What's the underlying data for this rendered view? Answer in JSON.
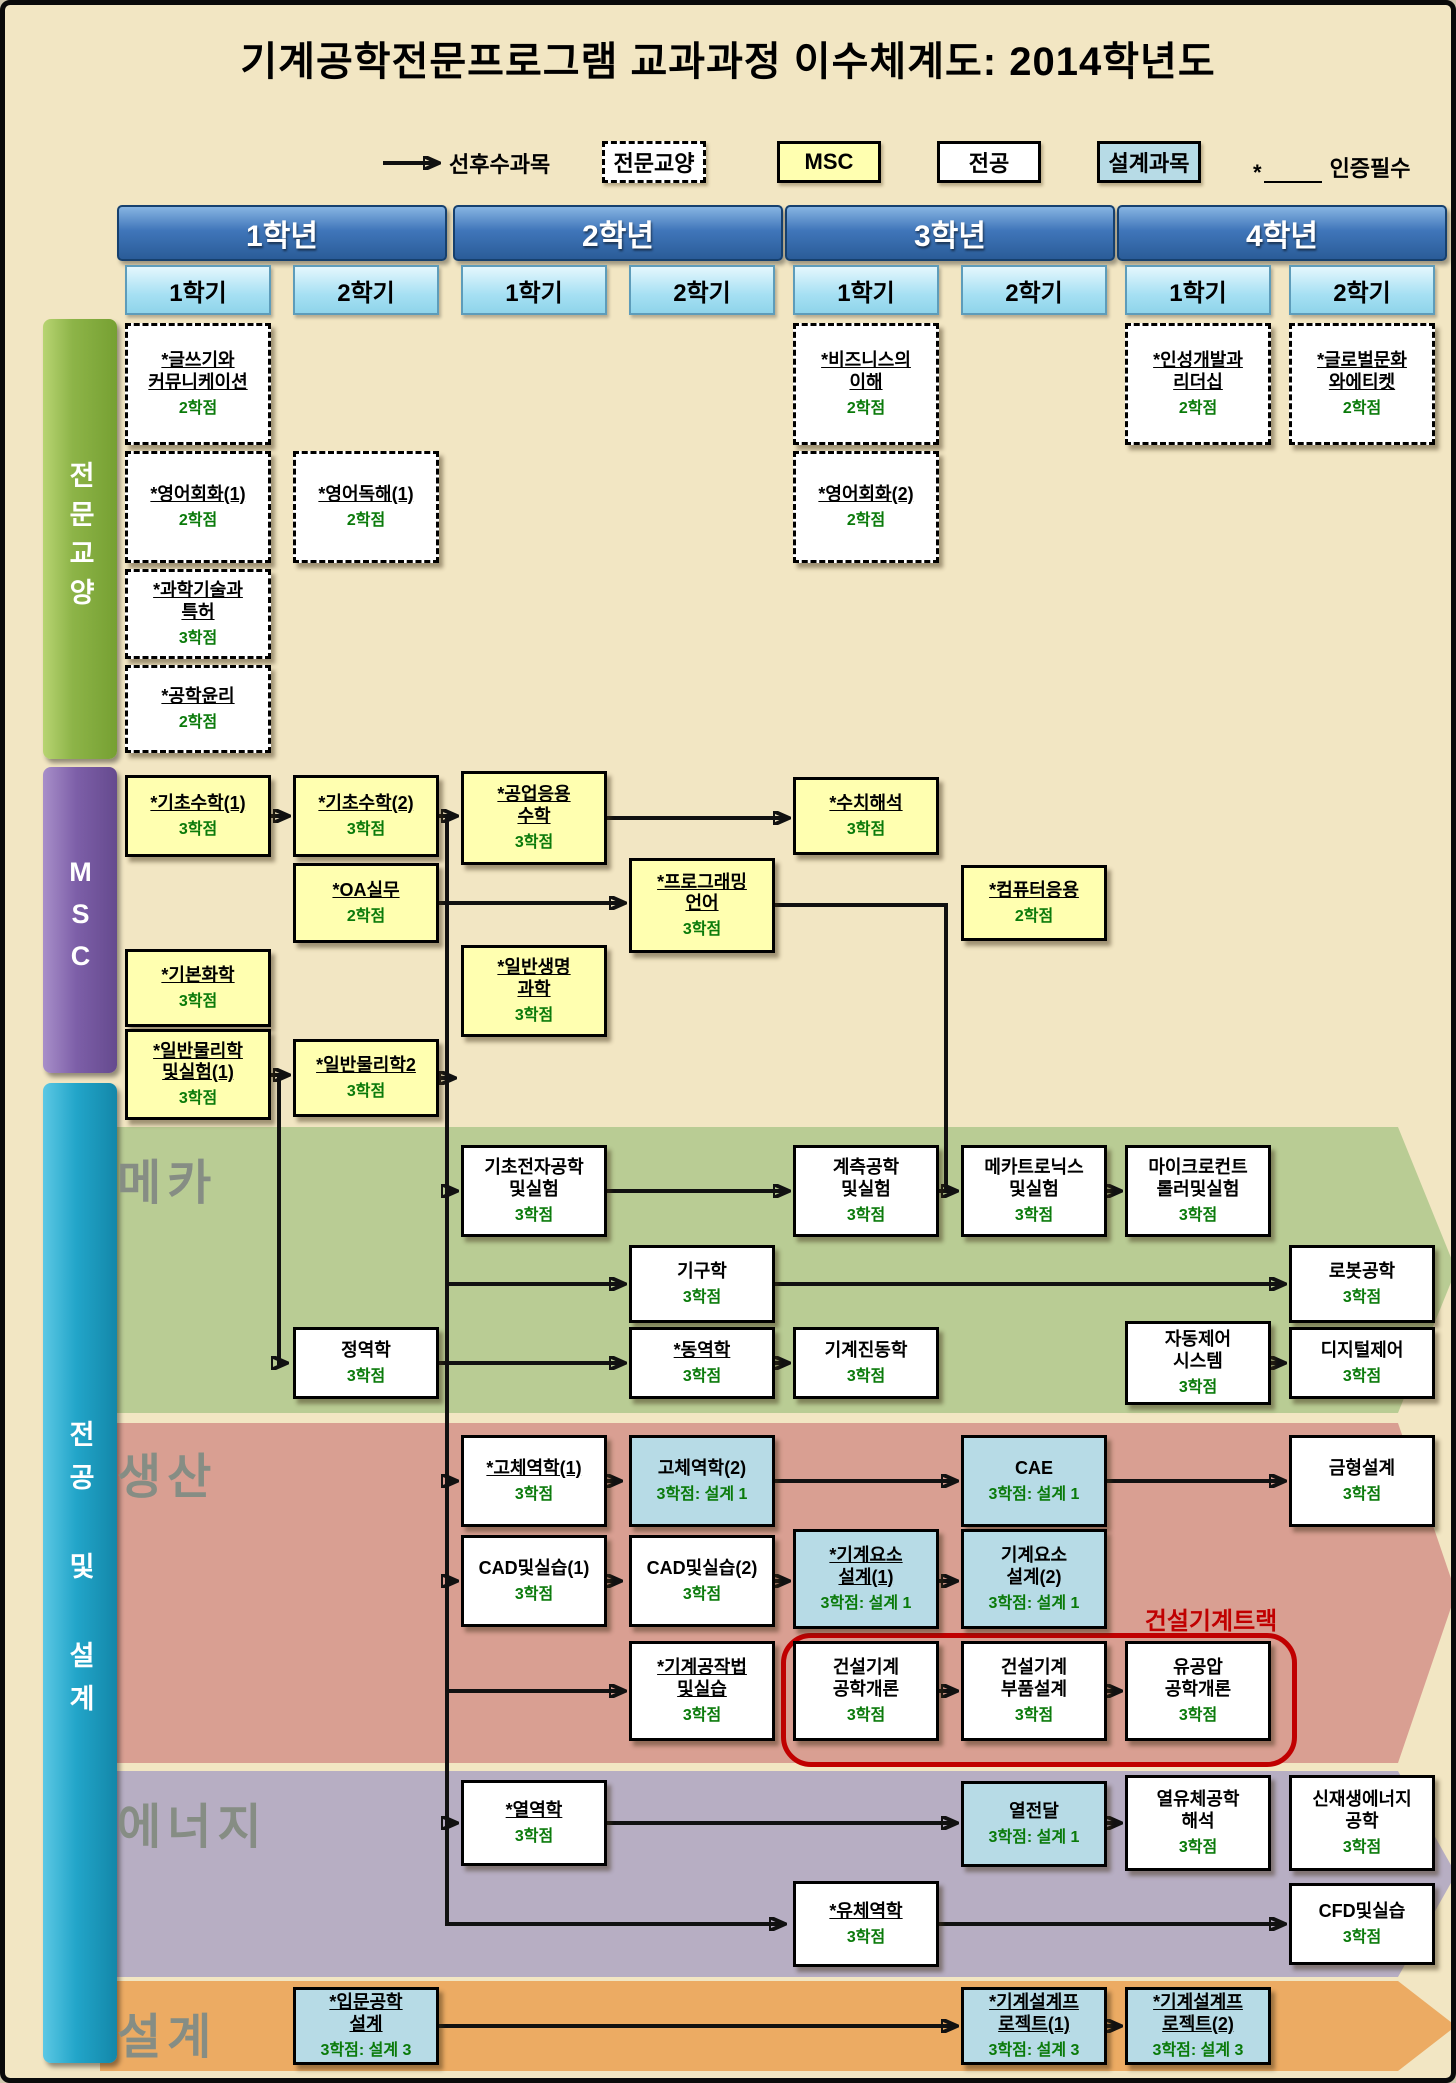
{
  "title": "기계공학전문프로그램 교과과정 이수체계도: 2014학년도",
  "legend": {
    "arrow_label": "선후수과목",
    "ge_label": "전문교양",
    "msc_label": "MSC",
    "major_label": "전공",
    "design_label": "설계과목",
    "cert_star": "*",
    "cert_label": "인증필수"
  },
  "header": {
    "years": [
      "1학년",
      "2학년",
      "3학년",
      "4학년"
    ],
    "semesters": [
      "1학기",
      "2학기",
      "1학기",
      "2학기",
      "1학기",
      "2학기",
      "1학기",
      "2학기"
    ]
  },
  "sidebars": [
    {
      "label": "전문교양"
    },
    {
      "label": "MSC"
    },
    {
      "label": "전공 및 설계"
    }
  ],
  "bands": [
    {
      "label": "메카"
    },
    {
      "label": "생산"
    },
    {
      "label": "에너지"
    },
    {
      "label": "설계"
    }
  ],
  "track": {
    "label": "건설기계트랙"
  },
  "colors": {
    "page_bg": "#f2e6c3",
    "year_bar_blue": "#2a5c98",
    "semester_tab_blue": "#a6e0f3",
    "ge_sidebar_green": "#8db448",
    "msc_sidebar_purple": "#7d5fa8",
    "major_sidebar_cyan": "#22a5c9",
    "band_mecha": "#b9cc94",
    "band_production": "#d99f92",
    "band_energy": "#b7aec3",
    "band_design": "#ecab63",
    "msc_box_yellow": "#ffffb0",
    "design_box_blue": "#b7dbe6",
    "credit_green": "#0a7a0a",
    "track_red": "#c00000"
  },
  "courses": [
    {
      "title": "*글쓰기와\n커뮤니케이션",
      "credit": "2학점",
      "category": "전문교양",
      "grade": 1,
      "semester": 1
    },
    {
      "title": "*영어회화(1)",
      "credit": "2학점",
      "category": "전문교양",
      "grade": 1,
      "semester": 1
    },
    {
      "title": "*과학기술과\n특허",
      "credit": "3학점",
      "category": "전문교양",
      "grade": 1,
      "semester": 1
    },
    {
      "title": "*공학윤리",
      "credit": "2학점",
      "category": "전문교양",
      "grade": 1,
      "semester": 1
    },
    {
      "title": "*영어독해(1)",
      "credit": "2학점",
      "category": "전문교양",
      "grade": 1,
      "semester": 2
    },
    {
      "title": "*비즈니스의\n이해",
      "credit": "2학점",
      "category": "전문교양",
      "grade": 3,
      "semester": 1
    },
    {
      "title": "*영어회화(2)",
      "credit": "2학점",
      "category": "전문교양",
      "grade": 3,
      "semester": 1
    },
    {
      "title": "*인성개발과\n리더십",
      "credit": "2학점",
      "category": "전문교양",
      "grade": 4,
      "semester": 1
    },
    {
      "title": "*글로벌문화\n와에티켓",
      "credit": "2학점",
      "category": "전문교양",
      "grade": 4,
      "semester": 2
    },
    {
      "title": "*기초수학(1)",
      "credit": "3학점",
      "category": "MSC",
      "grade": 1,
      "semester": 1
    },
    {
      "title": "*기초수학(2)",
      "credit": "3학점",
      "category": "MSC",
      "grade": 1,
      "semester": 2
    },
    {
      "title": "*공업응용\n수학",
      "credit": "3학점",
      "category": "MSC",
      "grade": 2,
      "semester": 1
    },
    {
      "title": "*수치해석",
      "credit": "3학점",
      "category": "MSC",
      "grade": 3,
      "semester": 1
    },
    {
      "title": "*OA실무",
      "credit": "2학점",
      "category": "MSC",
      "grade": 1,
      "semester": 2
    },
    {
      "title": "*프로그래밍\n언어",
      "credit": "3학점",
      "category": "MSC",
      "grade": 2,
      "semester": 2
    },
    {
      "title": "*컴퓨터응용",
      "credit": "2학점",
      "category": "MSC",
      "grade": 3,
      "semester": 2
    },
    {
      "title": "*기본화학",
      "credit": "3학점",
      "category": "MSC",
      "grade": 1,
      "semester": 1
    },
    {
      "title": "*일반생명\n과학",
      "credit": "3학점",
      "category": "MSC",
      "grade": 2,
      "semester": 1
    },
    {
      "title": "*일반물리학\n및실험(1)",
      "credit": "3학점",
      "category": "MSC",
      "grade": 1,
      "semester": 1
    },
    {
      "title": "*일반물리학2",
      "credit": "3학점",
      "category": "MSC",
      "grade": 1,
      "semester": 2
    },
    {
      "title": "기초전자공학\n및실험",
      "credit": "3학점",
      "category": "전공",
      "band": "메카",
      "grade": 2,
      "semester": 1
    },
    {
      "title": "계측공학\n및실험",
      "credit": "3학점",
      "category": "전공",
      "band": "메카",
      "grade": 3,
      "semester": 1
    },
    {
      "title": "메카트로닉스\n및실험",
      "credit": "3학점",
      "category": "전공",
      "band": "메카",
      "grade": 3,
      "semester": 2
    },
    {
      "title": "마이크로컨트\n롤러및실험",
      "credit": "3학점",
      "category": "전공",
      "band": "메카",
      "grade": 4,
      "semester": 1
    },
    {
      "title": "기구학",
      "credit": "3학점",
      "category": "전공",
      "band": "메카",
      "grade": 2,
      "semester": 2
    },
    {
      "title": "로봇공학",
      "credit": "3학점",
      "category": "전공",
      "band": "메카",
      "grade": 4,
      "semester": 2
    },
    {
      "title": "정역학",
      "credit": "3학점",
      "category": "전공",
      "band": "메카",
      "grade": 1,
      "semester": 2
    },
    {
      "title": "*동역학",
      "credit": "3학점",
      "category": "전공",
      "band": "메카",
      "grade": 2,
      "semester": 2
    },
    {
      "title": "기계진동학",
      "credit": "3학점",
      "category": "전공",
      "band": "메카",
      "grade": 3,
      "semester": 1
    },
    {
      "title": "자동제어\n시스템",
      "credit": "3학점",
      "category": "전공",
      "band": "메카",
      "grade": 4,
      "semester": 1
    },
    {
      "title": "디지털제어",
      "credit": "3학점",
      "category": "전공",
      "band": "메카",
      "grade": 4,
      "semester": 2
    },
    {
      "title": "*고체역학(1)",
      "credit": "3학점",
      "category": "전공",
      "band": "생산",
      "grade": 2,
      "semester": 1
    },
    {
      "title": "고체역학(2)",
      "credit": "3학점: 설계 1",
      "category": "설계과목",
      "band": "생산",
      "grade": 2,
      "semester": 2
    },
    {
      "title": "CAE",
      "credit": "3학점: 설계 1",
      "category": "설계과목",
      "band": "생산",
      "grade": 3,
      "semester": 2
    },
    {
      "title": "금형설계",
      "credit": "3학점",
      "category": "전공",
      "band": "생산",
      "grade": 4,
      "semester": 2
    },
    {
      "title": "CAD및실습(1)",
      "credit": "3학점",
      "category": "전공",
      "band": "생산",
      "grade": 2,
      "semester": 1
    },
    {
      "title": "CAD및실습(2)",
      "credit": "3학점",
      "category": "전공",
      "band": "생산",
      "grade": 2,
      "semester": 2
    },
    {
      "title": "*기계요소\n설계(1)",
      "credit": "3학점: 설계 1",
      "category": "설계과목",
      "band": "생산",
      "grade": 3,
      "semester": 1
    },
    {
      "title": "기계요소\n설계(2)",
      "credit": "3학점: 설계 1",
      "category": "설계과목",
      "band": "생산",
      "grade": 3,
      "semester": 2
    },
    {
      "title": "*기계공작법\n및실습",
      "credit": "3학점",
      "category": "전공",
      "band": "생산",
      "grade": 2,
      "semester": 2
    },
    {
      "title": "건설기계\n공학개론",
      "credit": "3학점",
      "category": "전공",
      "band": "생산",
      "grade": 3,
      "semester": 1
    },
    {
      "title": "건설기계\n부품설계",
      "credit": "3학점",
      "category": "전공",
      "band": "생산",
      "grade": 3,
      "semester": 2
    },
    {
      "title": "유공압\n공학개론",
      "credit": "3학점",
      "category": "전공",
      "band": "생산",
      "grade": 4,
      "semester": 1
    },
    {
      "title": "*열역학",
      "credit": "3학점",
      "category": "전공",
      "band": "에너지",
      "grade": 2,
      "semester": 1
    },
    {
      "title": "열전달",
      "credit": "3학점: 설계 1",
      "category": "설계과목",
      "band": "에너지",
      "grade": 3,
      "semester": 2
    },
    {
      "title": "열유체공학\n해석",
      "credit": "3학점",
      "category": "전공",
      "band": "에너지",
      "grade": 4,
      "semester": 1
    },
    {
      "title": "신재생에너지\n공학",
      "credit": "3학점",
      "category": "전공",
      "band": "에너지",
      "grade": 4,
      "semester": 2
    },
    {
      "title": "*유체역학",
      "credit": "3학점",
      "category": "전공",
      "band": "에너지",
      "grade": 3,
      "semester": 1
    },
    {
      "title": "CFD및실습",
      "credit": "3학점",
      "category": "전공",
      "band": "에너지",
      "grade": 4,
      "semester": 2
    },
    {
      "title": "*입문공학\n설계",
      "credit": "3학점: 설계 3",
      "category": "설계과목",
      "band": "설계",
      "grade": 1,
      "semester": 2
    },
    {
      "title": "*기계설계프\n로젝트(1)",
      "credit": "3학점: 설계 3",
      "category": "설계과목",
      "band": "설계",
      "grade": 3,
      "semester": 2
    },
    {
      "title": "*기계설계프\n로젝트(2)",
      "credit": "3학점: 설계 3",
      "category": "설계과목",
      "band": "설계",
      "grade": 4,
      "semester": 1
    }
  ]
}
